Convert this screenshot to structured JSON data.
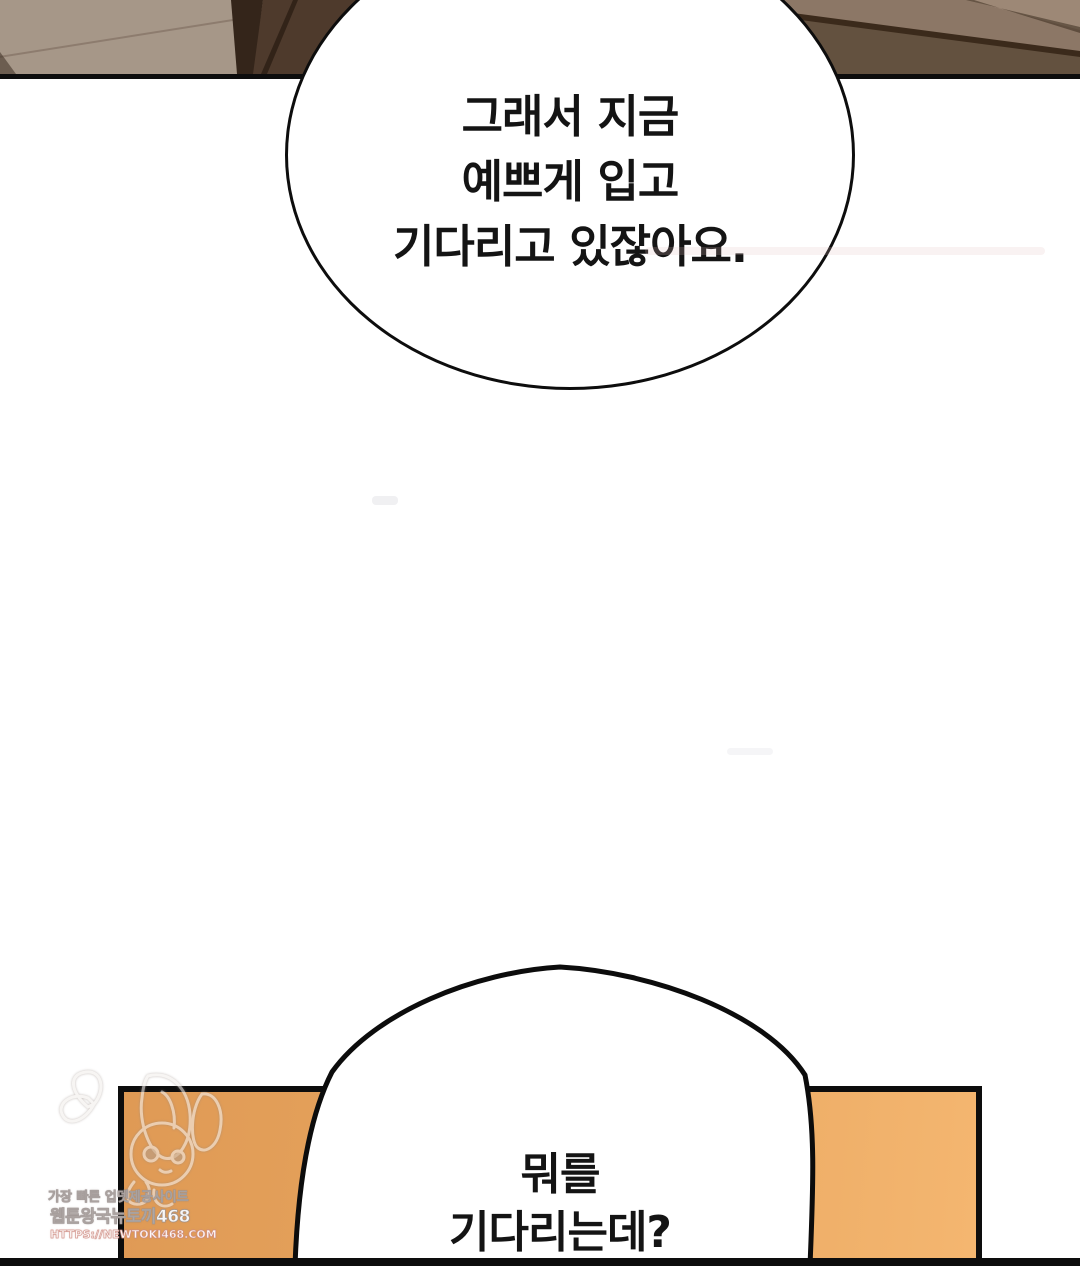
{
  "page": {
    "kind": "webtoon-comic-page",
    "background_color": "#ffffff",
    "width_px": 1080,
    "height_px": 1266
  },
  "bubbles": {
    "top": {
      "text": "그래서 지금\n예쁘게 입고\n기다리고 있잖아요."
    },
    "bottom": {
      "text": "뭐를\n기다리는데?"
    }
  },
  "panels": {
    "top_scene": {
      "base_color": "#a69788",
      "dark_wedge_color": "#34251a",
      "mid_brown_color": "#4e3a2c",
      "right_top_color": "#8c7766",
      "right_dark_color": "#63513f",
      "border_color": "#0d0d0d"
    },
    "bottom_scene": {
      "fill_left_color": "#df9a55",
      "fill_right_color": "#f4b670",
      "border_color": "#0d0d0d"
    }
  },
  "watermark": {
    "line1": "가장 빠른 업뎃제공사이트",
    "line2": "웹툰왕국뉴토끼468",
    "line3": "HTTPS://NEWTOKI468.COM",
    "sketch_icon": "chibi-character-sketch"
  }
}
